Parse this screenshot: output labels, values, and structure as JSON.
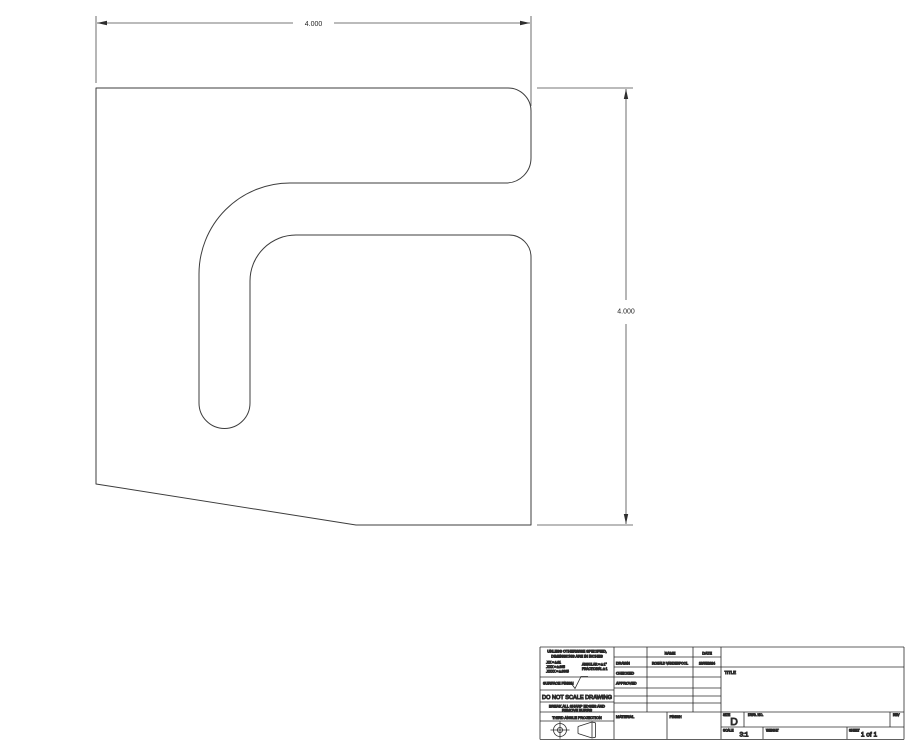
{
  "drawing_view": {
    "width_dim": "4.000",
    "height_dim": "4.000"
  },
  "title_block": {
    "general_note": [
      "UNLESS OTHERWISE SPECIFIED,",
      "DIMENSIONS ARE IN INCHES"
    ],
    "tolerances": {
      "xx": ".XX = ±.01",
      "xxx": ".XXX = ±.005",
      "xxxx": ".XXXX = ±.0005",
      "angular": "ANGULAR = ± 1°",
      "fractional": "FRACTIONAL ± 1"
    },
    "surface_finish_label": "SURFACE FINISH",
    "do_not_scale": "DO NOT SCALE DRAWING",
    "break_edges": [
      "BREAK ALL SHARP EDGES AND",
      "REMOVE BURRS"
    ],
    "projection_label": "THIRD ANGLE PROJECTION",
    "approval_table": {
      "name_header": "NAME",
      "date_header": "DATE",
      "rows": [
        {
          "label": "DRAWN",
          "name": "RONALD VANDERPOOL",
          "date": "10/05/2024"
        },
        {
          "label": "CHECKED",
          "name": "",
          "date": ""
        },
        {
          "label": "APPROVED",
          "name": "",
          "date": ""
        }
      ]
    },
    "material_label": "MATERIAL",
    "finish_label": "FINISH",
    "title_label": "TITLE",
    "size_label": "SIZE",
    "size_value": "D",
    "dwg_no_label": "DWG. NO.",
    "rev_label": "REV",
    "scale_label": "SCALE",
    "scale_value": "3:1",
    "weight_label": "WEIGHT",
    "sheet_label": "SHEET",
    "sheet_value": "1 of 1"
  },
  "colors": {
    "line": "#3c3c3c",
    "title_block_line": "#2b2b2b",
    "background": "#ffffff"
  }
}
